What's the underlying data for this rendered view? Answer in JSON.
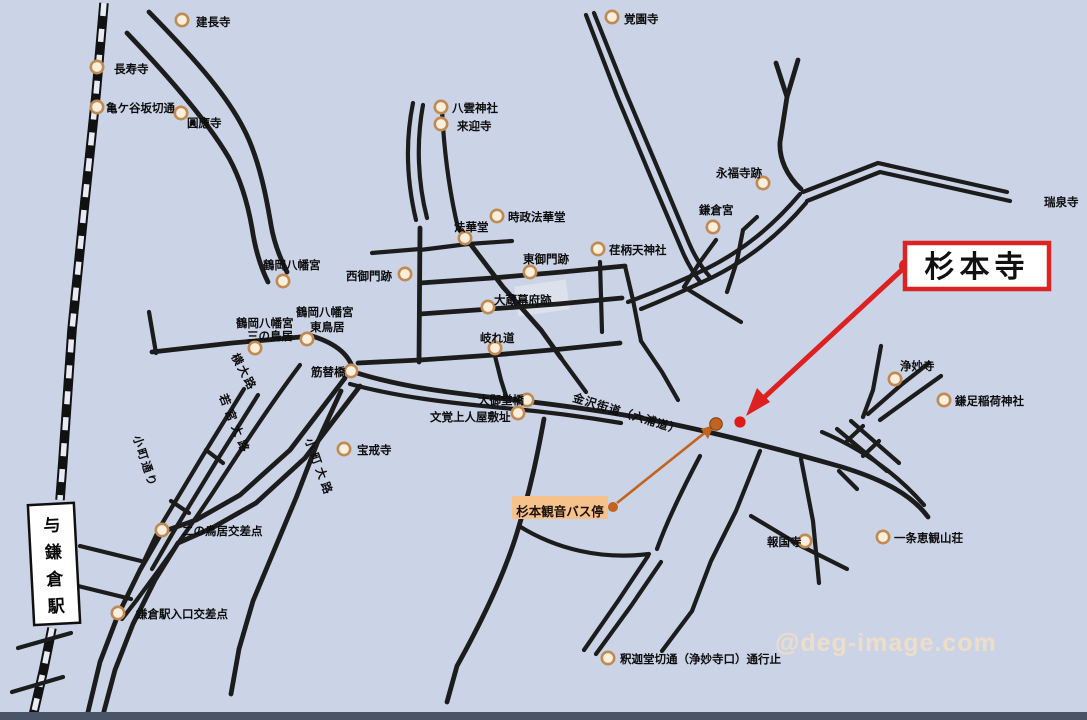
{
  "map": {
    "region_title": "鎌倉 杉本寺 周辺地図",
    "watermark": "@deg-image.com",
    "colors": {
      "background": "#cbd3e6",
      "road": "#1c1c1c",
      "poi_circle_fill": "#faeedd",
      "poi_circle_stroke": "#c08a52",
      "highlight_red": "#dd2020",
      "route_orange": "#c2641e",
      "bus_label_bg": "#f6c18a",
      "bottom_bar": "#4a5468"
    },
    "callout": {
      "label": "杉本寺"
    },
    "bus_stop": {
      "label": "杉本観音バス停"
    },
    "station": {
      "symbol": "与",
      "name": "鎌倉駅"
    },
    "landmarks": [
      {
        "name": "建長寺",
        "circle": {
          "x": 182,
          "y": 20
        },
        "lines": [
          {
            "t": "建長寺",
            "x": 196,
            "y": 26
          }
        ]
      },
      {
        "name": "長寿寺",
        "circle": {
          "x": 97,
          "y": 67
        },
        "lines": [
          {
            "t": "長寿寺",
            "x": 114,
            "y": 73
          }
        ]
      },
      {
        "name": "亀ケ谷坂切通",
        "circle": {
          "x": 97,
          "y": 107
        },
        "lines": [
          {
            "t": "亀ケ谷坂切通",
            "x": 106,
            "y": 112
          }
        ]
      },
      {
        "name": "圓應寺",
        "circle": {
          "x": 181,
          "y": 113
        },
        "lines": [
          {
            "t": "圓應寺",
            "x": 187,
            "y": 127
          }
        ]
      },
      {
        "name": "覚園寺",
        "circle": {
          "x": 612,
          "y": 17
        },
        "lines": [
          {
            "t": "覚園寺",
            "x": 624,
            "y": 23
          }
        ]
      },
      {
        "name": "八雲神社",
        "circle": {
          "x": 441,
          "y": 107
        },
        "lines": [
          {
            "t": "八雲神社",
            "x": 452,
            "y": 112
          }
        ]
      },
      {
        "name": "来迎寺",
        "circle": {
          "x": 441,
          "y": 124
        },
        "lines": [
          {
            "t": "来迎寺",
            "x": 457,
            "y": 130
          }
        ]
      },
      {
        "name": "永福寺跡",
        "circle": {
          "x": 763,
          "y": 183
        },
        "lines": [
          {
            "t": "永福寺跡",
            "x": 716,
            "y": 177
          }
        ]
      },
      {
        "name": "鎌倉宮",
        "circle": {
          "x": 713,
          "y": 227
        },
        "lines": [
          {
            "t": "鎌倉宮",
            "x": 699,
            "y": 214
          }
        ]
      },
      {
        "name": "瑞泉寺",
        "lines": [
          {
            "t": "瑞泉寺",
            "x": 1044,
            "y": 206
          }
        ]
      },
      {
        "name": "時政法華堂",
        "circle": {
          "x": 497,
          "y": 216
        },
        "lines": [
          {
            "t": "時政法華堂",
            "x": 508,
            "y": 221
          }
        ]
      },
      {
        "name": "法華堂",
        "circle": {
          "x": 465,
          "y": 238
        },
        "lines": [
          {
            "t": "法華堂",
            "x": 454,
            "y": 231
          }
        ]
      },
      {
        "name": "東御門跡",
        "circle": {
          "x": 530,
          "y": 272
        },
        "lines": [
          {
            "t": "東御門跡",
            "x": 523,
            "y": 263
          }
        ]
      },
      {
        "name": "荏柄天神社",
        "circle": {
          "x": 598,
          "y": 249
        },
        "lines": [
          {
            "t": "荏柄天神社",
            "x": 609,
            "y": 254
          }
        ]
      },
      {
        "name": "西御門跡",
        "circle": {
          "x": 405,
          "y": 274
        },
        "lines": [
          {
            "t": "西御門跡",
            "x": 346,
            "y": 280
          }
        ]
      },
      {
        "name": "大蔵幕府跡",
        "circle": {
          "x": 488,
          "y": 307
        },
        "lines": [
          {
            "t": "大蔵幕府跡",
            "x": 494,
            "y": 304
          }
        ]
      },
      {
        "name": "鶴岡八幡宮",
        "circle": {
          "x": 283,
          "y": 281
        },
        "lines": [
          {
            "t": "鶴岡八幡宮",
            "x": 263,
            "y": 269
          }
        ]
      },
      {
        "name": "鶴岡八幡宮東鳥居",
        "circle": {
          "x": 307,
          "y": 339
        },
        "lines": [
          {
            "t": "鶴岡八幡宮",
            "x": 296,
            "y": 316
          },
          {
            "t": "東鳥居",
            "x": 310,
            "y": 331
          }
        ]
      },
      {
        "name": "鶴岡八幡宮三の鳥居",
        "circle": {
          "x": 255,
          "y": 348
        },
        "lines": [
          {
            "t": "鶴岡八幡宮",
            "x": 236,
            "y": 327
          },
          {
            "t": "三の鳥居",
            "x": 247,
            "y": 340
          }
        ]
      },
      {
        "name": "筋替橋",
        "circle": {
          "x": 351,
          "y": 371
        },
        "lines": [
          {
            "t": "筋替橋",
            "x": 311,
            "y": 376
          }
        ]
      },
      {
        "name": "岐れ道",
        "circle": {
          "x": 495,
          "y": 348
        },
        "lines": [
          {
            "t": "岐れ道",
            "x": 480,
            "y": 342
          }
        ]
      },
      {
        "name": "大御堂橋",
        "circle": {
          "x": 527,
          "y": 400
        },
        "lines": [
          {
            "t": "大御堂橋",
            "x": 478,
            "y": 404
          }
        ]
      },
      {
        "name": "文覚上人屋敷址",
        "circle": {
          "x": 518,
          "y": 413
        },
        "lines": [
          {
            "t": "文覚上人屋敷址",
            "x": 430,
            "y": 421
          }
        ]
      },
      {
        "name": "宝戒寺",
        "circle": {
          "x": 344,
          "y": 449
        },
        "lines": [
          {
            "t": "宝戒寺",
            "x": 357,
            "y": 454
          }
        ]
      },
      {
        "name": "二の鳥居交差点",
        "circle": {
          "x": 162,
          "y": 530
        },
        "lines": [
          {
            "t": "二の鳥居交差点",
            "x": 182,
            "y": 535
          }
        ]
      },
      {
        "name": "鎌倉駅入口交差点",
        "circle": {
          "x": 118,
          "y": 613
        },
        "lines": [
          {
            "t": "鎌倉駅入口交差点",
            "x": 136,
            "y": 618
          }
        ]
      },
      {
        "name": "釈迦堂切通（浄妙寺口）通行止",
        "circle": {
          "x": 608,
          "y": 658
        },
        "lines": [
          {
            "t": "釈迦堂切通（浄妙寺口）通行止",
            "x": 620,
            "y": 663
          }
        ]
      },
      {
        "name": "報国寺",
        "circle": {
          "x": 805,
          "y": 541
        },
        "lines": [
          {
            "t": "報国寺",
            "x": 767,
            "y": 546
          }
        ]
      },
      {
        "name": "一条恵観山荘",
        "circle": {
          "x": 883,
          "y": 537
        },
        "lines": [
          {
            "t": "一条恵観山荘",
            "x": 894,
            "y": 542
          }
        ]
      },
      {
        "name": "浄妙寺",
        "circle": {
          "x": 895,
          "y": 379
        },
        "lines": [
          {
            "t": "浄妙寺",
            "x": 900,
            "y": 370
          }
        ]
      },
      {
        "name": "鎌足稲荷神社",
        "circle": {
          "x": 944,
          "y": 400
        },
        "lines": [
          {
            "t": "鎌足稲荷神社",
            "x": 955,
            "y": 405
          }
        ]
      }
    ],
    "road_labels": [
      {
        "text": "横大路",
        "x": 231,
        "y": 356,
        "rot": 62,
        "spacing": 2
      },
      {
        "text": "小町通り",
        "x": 133,
        "y": 437,
        "rot": 72,
        "spacing": 2
      },
      {
        "text": "若宮大路",
        "x": 219,
        "y": 396,
        "rot": 68,
        "spacing": 5
      },
      {
        "text": "小町大路",
        "x": 305,
        "y": 440,
        "rot": 70,
        "spacing": 4
      },
      {
        "text": "金沢街道（六浦道）",
        "x": 572,
        "y": 401,
        "rot": 17,
        "spacing": 1
      }
    ]
  }
}
